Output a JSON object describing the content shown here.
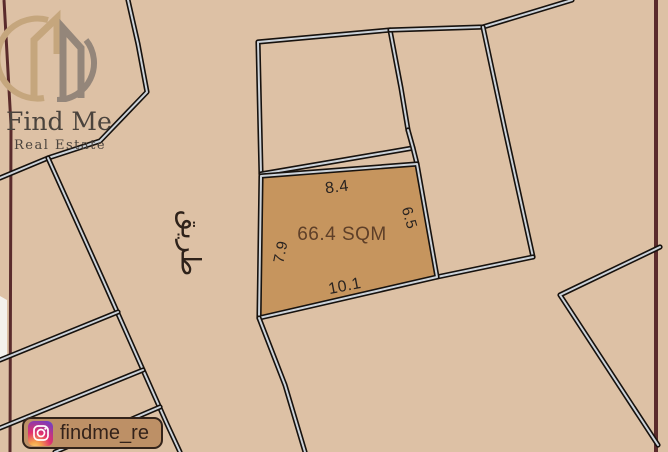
{
  "branding": {
    "logo_title": "Find Me",
    "logo_subtitle": "Real Estate",
    "instagram_handle": "findme_re"
  },
  "map": {
    "road_label_ar": "طريق",
    "plot": {
      "area_label": "66.4 SQM",
      "dimensions": {
        "top": "8.4",
        "right": "6.5",
        "left": "7.9",
        "bottom": "10.1"
      }
    }
  },
  "colors": {
    "background": "#ddc1a5",
    "plot_fill": "#c6955e",
    "line_outer": "#17120e",
    "line_inner": "#ccd3da",
    "frame_maroon": "#5a2b2c",
    "area_text": "#5e3f28",
    "dimension_text": "#292320",
    "badge_background": "#bd9066",
    "badge_text": "#33221a",
    "logo_text": "#4a433d"
  }
}
